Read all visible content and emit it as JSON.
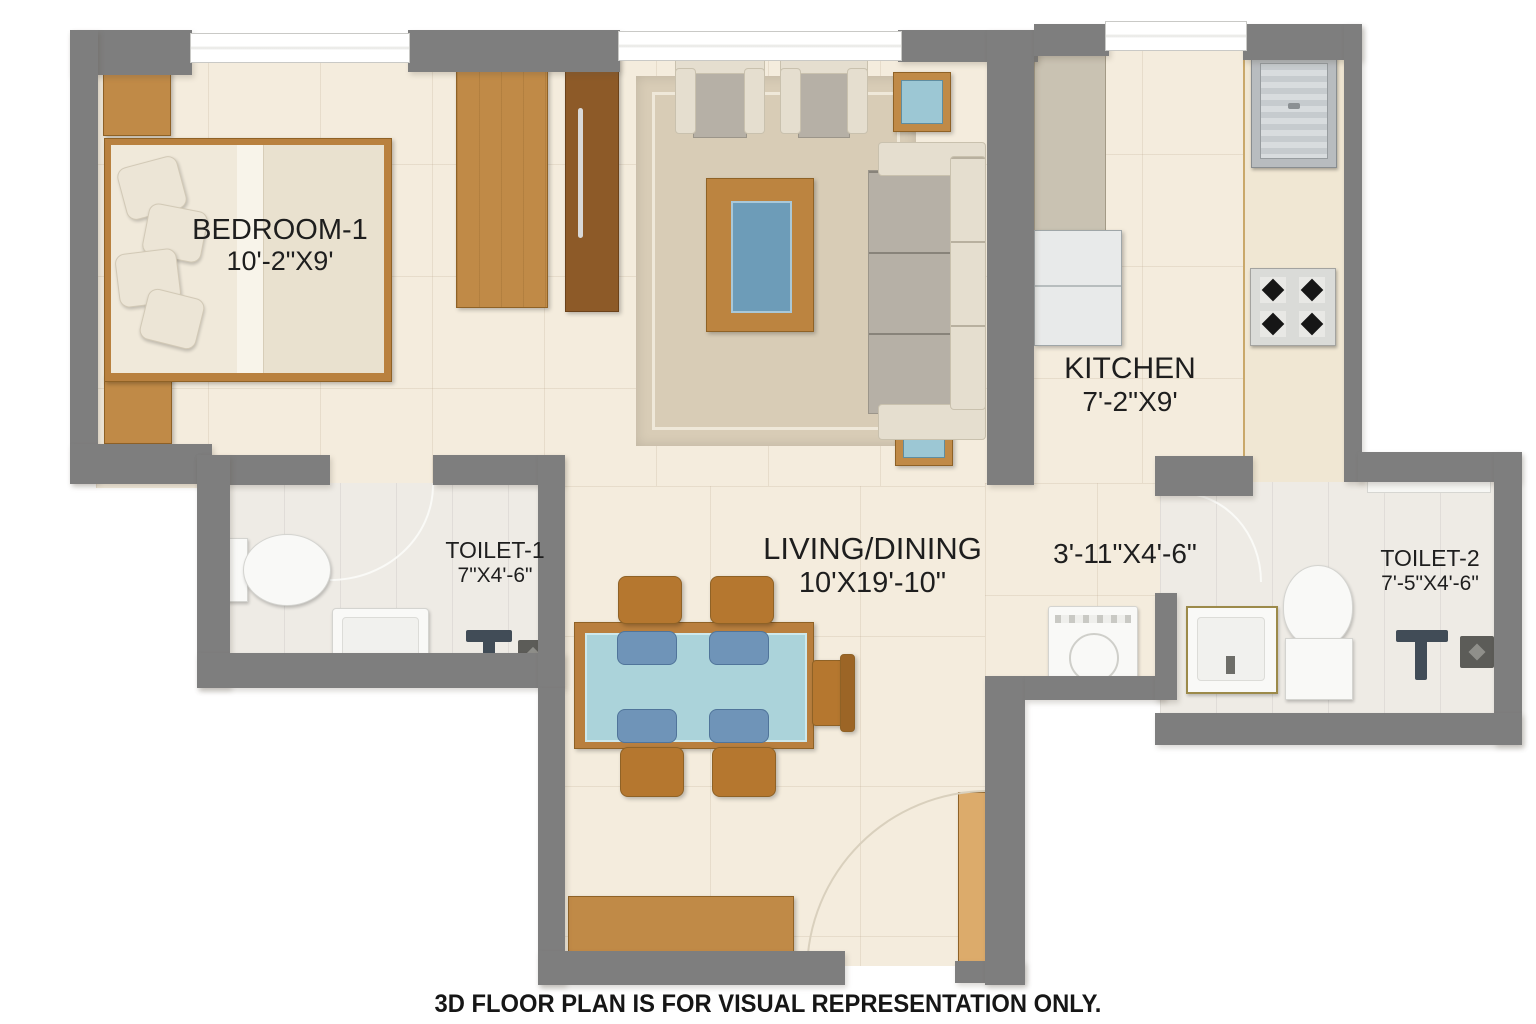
{
  "footer": {
    "disclaimer": "3D FLOOR PLAN IS FOR VISUAL REPRESENTATION ONLY."
  },
  "rooms": {
    "bedroom1": {
      "name": "BEDROOM-1",
      "dimensions": "10'-2\"X9'"
    },
    "living_dining": {
      "name": "LIVING/DINING",
      "dimensions": "10'X19'-10\""
    },
    "kitchen": {
      "name": "KITCHEN",
      "dimensions": "7'-2\"X9'"
    },
    "toilet1": {
      "name": "TOILET-1",
      "dimensions": "7\"X4'-6\""
    },
    "toilet2": {
      "name": "TOILET-2",
      "dimensions": "7'-5\"X4'-6\""
    },
    "passage": {
      "dimensions": "3'-11\"X4'-6\""
    }
  },
  "colors": {
    "wall": "#7e7e7e",
    "floor": "#f4ecdd",
    "toilet_floor": "#eeebe5",
    "wood": "#c08a47",
    "wood_dark": "#8d5a28",
    "upholstery_gray": "#b6b0a6",
    "upholstery_cream": "#e5decf",
    "coffee_table_glass": "#6d9cb8",
    "dining_glass": "#abd3da",
    "seat_blue": "#6f94b8",
    "fixture_white": "#f9f9f7",
    "steel": "#b8bcbf"
  }
}
